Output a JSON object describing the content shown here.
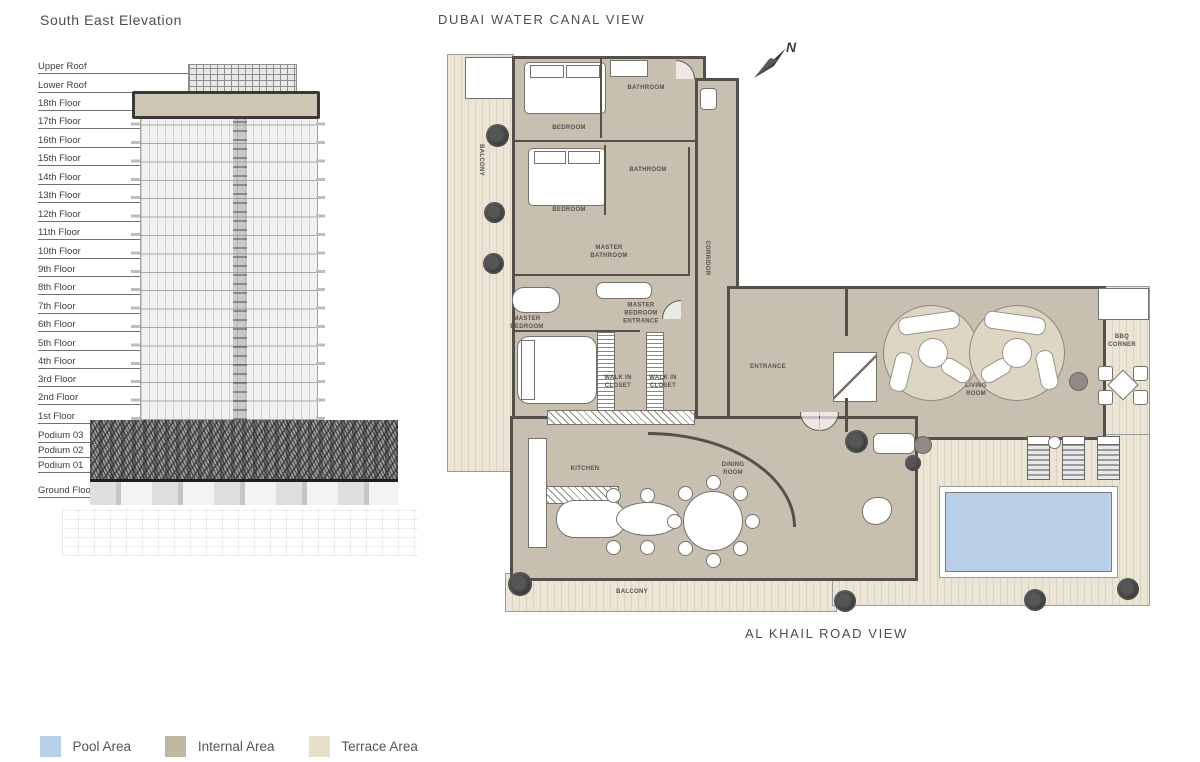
{
  "titles": {
    "elevation": "South East Elevation",
    "plan_top": "DUBAI WATER CANAL VIEW",
    "plan_bottom": "AL KHAIL ROAD VIEW",
    "north": "N"
  },
  "elevation": {
    "floors": [
      "Upper Roof",
      "Lower Roof",
      "18th Floor",
      "17th Floor",
      "16th Floor",
      "15th Floor",
      "14th Floor",
      "13th Floor",
      "12th Floor",
      "11th Floor",
      "10th Floor",
      "9th Floor",
      "8th Floor",
      "7th Floor",
      "6th Floor",
      "5th Floor",
      "4th Floor",
      "3rd Floor",
      "2nd Floor",
      "1st Floor",
      "Podium 03",
      "Podium 02",
      "Podium 01",
      "Ground Floor"
    ]
  },
  "plan": {
    "rooms": {
      "balcony_left": "BALCONY",
      "bedroom_1": "BEDROOM",
      "bathroom_1": "BATHROOM",
      "bedroom_2": "BEDROOM",
      "bathroom_2": "BATHROOM",
      "master_bathroom": "MASTER BATHROOM",
      "corridor": "CORRIDOR",
      "master_bedroom": "MASTER BEDROOM",
      "master_bedroom_entrance": "MASTER BEDROOM ENTRANCE",
      "walk_in_closet_1": "WALK IN CLOSET",
      "walk_in_closet_2": "WALK IN CLOSET",
      "entrance": "ENTRANCE",
      "living_room": "LIVING ROOM",
      "kitchen": "KITCHEN",
      "dining_room": "DINING ROOM",
      "bbq_corner": "BBQ CORNER",
      "balcony_bottom": "BALCONY"
    }
  },
  "legend": {
    "items": [
      {
        "label": "Pool Area",
        "color": "#b9cfe8"
      },
      {
        "label": "Internal Area",
        "color": "#bfb7a5"
      },
      {
        "label": "Terrace Area",
        "color": "#e6e0cb"
      }
    ]
  },
  "colors": {
    "pool": "#b9cfe8",
    "internal": "#c7c0b0",
    "terrace": "#eae5d5",
    "wall": "#54504a"
  }
}
